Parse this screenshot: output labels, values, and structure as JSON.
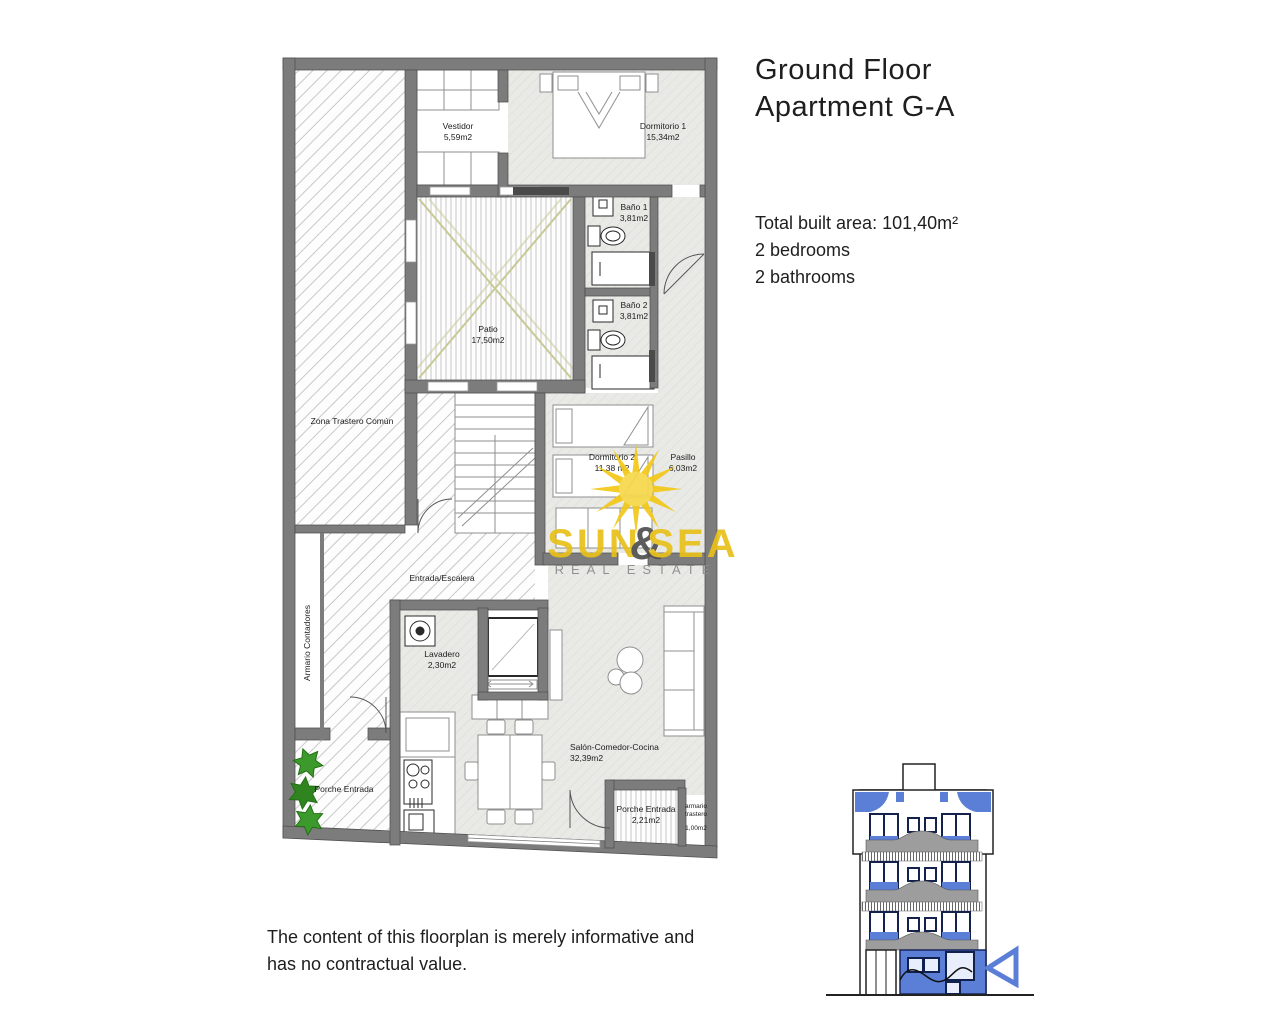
{
  "header": {
    "title_line1": "Ground Floor",
    "title_line2": "Apartment G-A"
  },
  "summary": {
    "total_area": "Total built area: 101,40m²",
    "bedrooms": "2 bedrooms",
    "bathrooms": "2 bathrooms"
  },
  "disclaimer": {
    "line1": "The content of this floorplan is merely informative and",
    "line2": "has no contractual value."
  },
  "logo": {
    "word1": "SUN",
    "ampersand": "&",
    "word2": "SEA",
    "tagline": "REAL ESTATE"
  },
  "floorplan": {
    "rooms": {
      "vestidor": {
        "label": "Vestidor",
        "area": "5,59m2"
      },
      "dormitorio1": {
        "label": "Dormitorio 1",
        "area": "15,34m2"
      },
      "bano1": {
        "label": "Baño 1",
        "area": "3,81m2"
      },
      "bano2": {
        "label": "Baño 2",
        "area": "3,81m2"
      },
      "patio": {
        "label": "Patio",
        "area": "17,50m2"
      },
      "zona_trastero": {
        "label": "Zona Trastero Común"
      },
      "dormitorio2": {
        "label": "Dormitorio 2",
        "area": "11,38 m2"
      },
      "pasillo": {
        "label": "Pasillo",
        "area": "6,03m2"
      },
      "entrada_escalera": {
        "label": "Entrada/Escalera"
      },
      "armario_contadores": {
        "label": "Armario Contadores"
      },
      "lavadero": {
        "label": "Lavadero",
        "area": "2,30m2"
      },
      "salon": {
        "label": "Salón-Comedor-Cocina",
        "area": "32,39m2"
      },
      "porche_entrada_lateral": {
        "label": "Porche Entrada"
      },
      "porche_entrada": {
        "label": "Porche Entrada",
        "area": "2,21m2"
      },
      "armario_trastero": {
        "line1": "armario",
        "line2": "trastero",
        "area": "1,00m2"
      }
    }
  },
  "colors": {
    "wall": "#7c7c7c",
    "floor": "#e9e9e6",
    "logo_yellow": "#e8c019",
    "logo_gray": "#8a8a8a",
    "accent_blue": "#5b7fd6",
    "plant_green": "#3c9a2c",
    "patio_cross": "#c9c996"
  }
}
